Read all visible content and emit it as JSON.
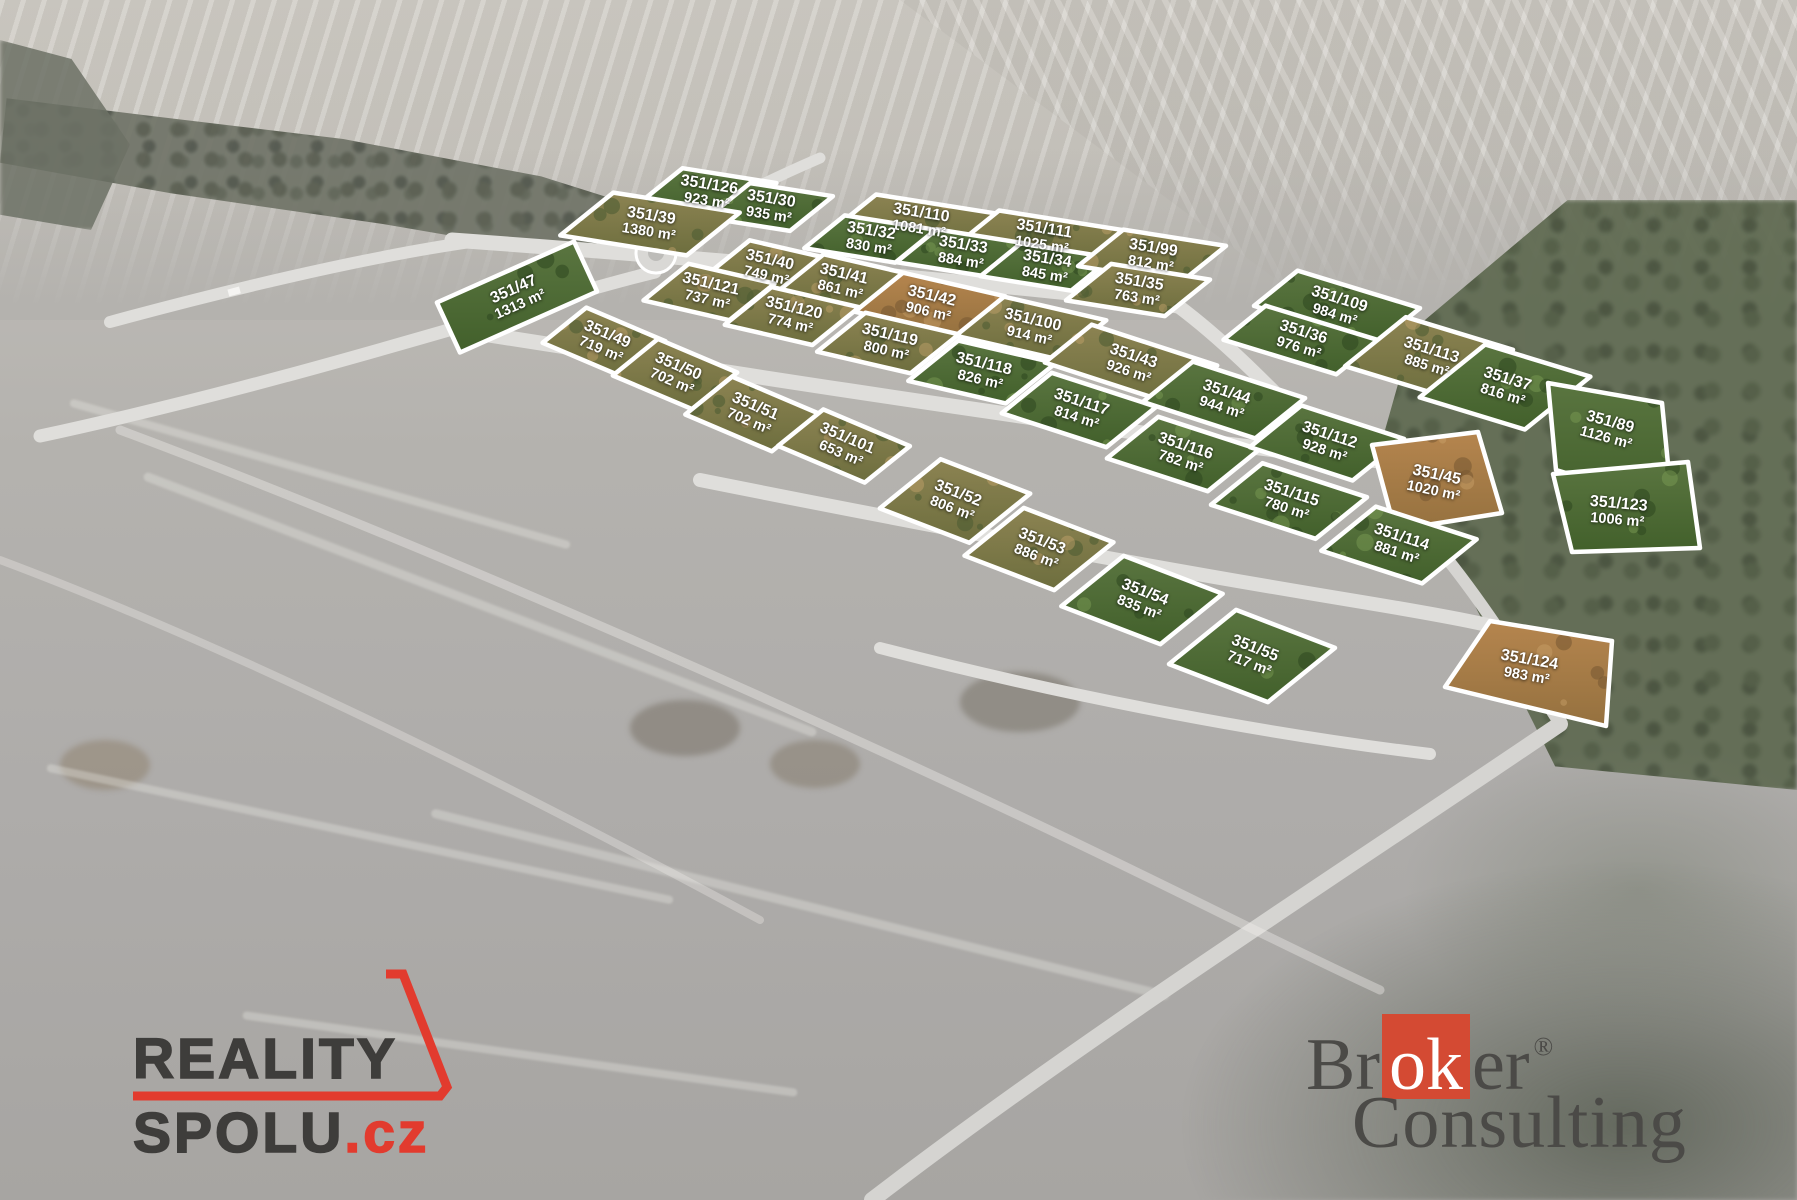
{
  "overlay": {
    "plot_outline_color": "#ffffff",
    "label_color": "#ffffff"
  },
  "plots": [
    {
      "id": "351/126",
      "area": "923 m²",
      "x": 708,
      "y": 193,
      "band": "a",
      "w": 95,
      "h": 55,
      "tone": "green"
    },
    {
      "id": "351/30",
      "area": "935 m²",
      "x": 770,
      "y": 207,
      "band": "a",
      "w": 84,
      "h": 55,
      "tone": "green"
    },
    {
      "id": "351/39",
      "area": "1380 m²",
      "x": 650,
      "y": 224,
      "band": "a",
      "w": 128,
      "h": 68,
      "tone": "mixed"
    },
    {
      "id": "351/110",
      "area": "1081 m²",
      "x": 920,
      "y": 221,
      "band": "a",
      "w": 130,
      "h": 52,
      "tone": "mixed"
    },
    {
      "id": "351/32",
      "area": "830 m²",
      "x": 870,
      "y": 239,
      "band": "a",
      "w": 92,
      "h": 52,
      "tone": "green"
    },
    {
      "id": "351/111",
      "area": "1025 m²",
      "x": 1043,
      "y": 237,
      "band": "a",
      "w": 130,
      "h": 52,
      "tone": "mixed"
    },
    {
      "id": "351/33",
      "area": "884 m²",
      "x": 962,
      "y": 253,
      "band": "a",
      "w": 92,
      "h": 52,
      "tone": "green"
    },
    {
      "id": "351/34",
      "area": "845 m²",
      "x": 1046,
      "y": 267,
      "band": "a",
      "w": 92,
      "h": 52,
      "tone": "green"
    },
    {
      "id": "351/99",
      "area": "812 m²",
      "x": 1152,
      "y": 256,
      "band": "a",
      "w": 104,
      "h": 58,
      "tone": "mixed"
    },
    {
      "id": "351/35",
      "area": "763 m²",
      "x": 1138,
      "y": 290,
      "band": "a",
      "w": 100,
      "h": 58,
      "tone": "mixed"
    },
    {
      "id": "351/47",
      "area": "1313 m²",
      "x": 517,
      "y": 297,
      "band": "g",
      "w": 150,
      "h": 55,
      "tone": "green"
    },
    {
      "id": "351/40",
      "area": "749 m²",
      "x": 768,
      "y": 268,
      "band": "b",
      "w": 84,
      "h": 58,
      "tone": "mixed"
    },
    {
      "id": "351/41",
      "area": "861 m²",
      "x": 842,
      "y": 282,
      "band": "b",
      "w": 84,
      "h": 58,
      "tone": "mixed"
    },
    {
      "id": "351/121",
      "area": "737 m²",
      "x": 709,
      "y": 292,
      "band": "b",
      "w": 88,
      "h": 58,
      "tone": "mixed"
    },
    {
      "id": "351/120",
      "area": "774 m²",
      "x": 792,
      "y": 316,
      "band": "b",
      "w": 90,
      "h": 60,
      "tone": "mixed"
    },
    {
      "id": "351/42",
      "area": "906 m²",
      "x": 930,
      "y": 304,
      "band": "b",
      "w": 105,
      "h": 62,
      "tone": "sand"
    },
    {
      "id": "351/100",
      "area": "914 m²",
      "x": 1031,
      "y": 328,
      "band": "b",
      "w": 105,
      "h": 62,
      "tone": "mixed"
    },
    {
      "id": "351/119",
      "area": "800 m²",
      "x": 888,
      "y": 343,
      "band": "b",
      "w": 96,
      "h": 62,
      "tone": "mixed"
    },
    {
      "id": "351/118",
      "area": "826 m²",
      "x": 982,
      "y": 372,
      "band": "b",
      "w": 100,
      "h": 64,
      "tone": "green"
    },
    {
      "id": "351/109",
      "area": "984 m²",
      "x": 1337,
      "y": 307,
      "band": "br",
      "w": 128,
      "h": 56,
      "tone": "green"
    },
    {
      "id": "351/36",
      "area": "976 m²",
      "x": 1301,
      "y": 340,
      "band": "br",
      "w": 118,
      "h": 54,
      "tone": "green"
    },
    {
      "id": "351/113",
      "area": "885 m²",
      "x": 1429,
      "y": 358,
      "band": "br",
      "w": 112,
      "h": 78,
      "tone": "mixed"
    },
    {
      "id": "351/37",
      "area": "816 m²",
      "x": 1505,
      "y": 387,
      "band": "br",
      "w": 110,
      "h": 84,
      "tone": "green"
    },
    {
      "id": "351/89",
      "area": "1126 m²",
      "x": 1608,
      "y": 430,
      "rot": 15,
      "tone": "green",
      "poly": [
        [
          1548,
          383
        ],
        [
          1662,
          403
        ],
        [
          1672,
          505
        ],
        [
          1556,
          470
        ]
      ]
    },
    {
      "id": "351/49",
      "area": "719 m²",
      "x": 604,
      "y": 342,
      "band": "cl",
      "w": 86,
      "h": 56,
      "tone": "mixed"
    },
    {
      "id": "351/50",
      "area": "702 m²",
      "x": 675,
      "y": 374,
      "band": "cl",
      "w": 86,
      "h": 58,
      "tone": "mixed"
    },
    {
      "id": "351/51",
      "area": "702 m²",
      "x": 752,
      "y": 414,
      "band": "cl",
      "w": 94,
      "h": 60,
      "tone": "mixed"
    },
    {
      "id": "351/101",
      "area": "653 m²",
      "x": 844,
      "y": 446,
      "band": "cl",
      "w": 94,
      "h": 58,
      "tone": "mixed"
    },
    {
      "id": "351/43",
      "area": "926 m²",
      "x": 1131,
      "y": 364,
      "band": "cr",
      "w": 132,
      "h": 60,
      "tone": "mixed"
    },
    {
      "id": "351/117",
      "area": "814 m²",
      "x": 1079,
      "y": 410,
      "band": "cr",
      "w": 110,
      "h": 64,
      "tone": "green"
    },
    {
      "id": "351/44",
      "area": "944 m²",
      "x": 1224,
      "y": 400,
      "band": "cr",
      "w": 118,
      "h": 64,
      "tone": "green"
    },
    {
      "id": "351/116",
      "area": "782 m²",
      "x": 1183,
      "y": 454,
      "band": "cr",
      "w": 106,
      "h": 66,
      "tone": "green"
    },
    {
      "id": "351/112",
      "area": "928 m²",
      "x": 1327,
      "y": 443,
      "band": "cr",
      "w": 108,
      "h": 66,
      "tone": "green"
    },
    {
      "id": "351/115",
      "area": "780 m²",
      "x": 1289,
      "y": 501,
      "band": "cr",
      "w": 110,
      "h": 66,
      "tone": "green"
    },
    {
      "id": "351/45",
      "area": "1020 m²",
      "x": 1435,
      "y": 483,
      "rot": 12,
      "tone": "sand",
      "poly": [
        [
          1372,
          445
        ],
        [
          1478,
          432
        ],
        [
          1502,
          513
        ],
        [
          1395,
          530
        ]
      ]
    },
    {
      "id": "351/114",
      "area": "881 m²",
      "x": 1399,
      "y": 545,
      "band": "cr",
      "w": 106,
      "h": 70,
      "tone": "green"
    },
    {
      "id": "351/123",
      "area": "1006 m²",
      "x": 1618,
      "y": 512,
      "rot": 5,
      "tone": "green",
      "poly": [
        [
          1553,
          474
        ],
        [
          1688,
          462
        ],
        [
          1700,
          548
        ],
        [
          1572,
          552
        ]
      ]
    },
    {
      "id": "351/52",
      "area": "806 m²",
      "x": 955,
      "y": 501,
      "band": "d",
      "w": 96,
      "h": 78,
      "tone": "mixed"
    },
    {
      "id": "351/53",
      "area": "886 m²",
      "x": 1039,
      "y": 549,
      "band": "d",
      "w": 96,
      "h": 76,
      "tone": "mixed"
    },
    {
      "id": "351/54",
      "area": "835 m²",
      "x": 1142,
      "y": 600,
      "band": "d",
      "w": 106,
      "h": 80,
      "tone": "green"
    },
    {
      "id": "351/55",
      "area": "717 m²",
      "x": 1252,
      "y": 656,
      "band": "d",
      "w": 106,
      "h": 86,
      "tone": "green"
    },
    {
      "id": "351/124",
      "area": "983 m²",
      "x": 1528,
      "y": 668,
      "rot": 10,
      "tone": "sand",
      "poly": [
        [
          1445,
          687
        ],
        [
          1490,
          621
        ],
        [
          1612,
          641
        ],
        [
          1606,
          726
        ]
      ]
    }
  ],
  "branding": {
    "reality_spolu": {
      "line1": "REALITY",
      "line2": "SPOLU",
      "tld": ".cz",
      "accent": "#e23b2e",
      "text_color": "#3e3d3b"
    },
    "broker_consulting": {
      "pre": "Br",
      "highlight": "ok",
      "post": "er",
      "registered": "®",
      "line2": "Consulting",
      "accent": "#d44a33",
      "text_color": "#4b4a47"
    }
  }
}
